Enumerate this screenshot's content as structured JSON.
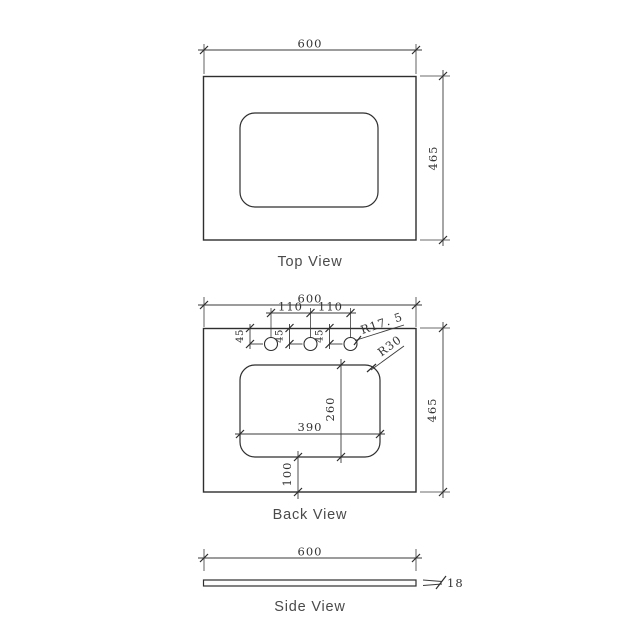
{
  "top_view": {
    "label": "Top View",
    "width": "600",
    "height": "465"
  },
  "back_view": {
    "label": "Back View",
    "width": "600",
    "height": "465",
    "hole_spacings": [
      "110",
      "110"
    ],
    "hole_offsets": [
      "45",
      "45",
      "45"
    ],
    "hole_radius_label": "R17. 5",
    "basin_corner_radius_label": "R30",
    "basin_width": "390",
    "basin_depth": "260",
    "basin_bottom_offset": "100"
  },
  "side_view": {
    "label": "Side View",
    "width": "600",
    "thickness": "18"
  },
  "colors": {
    "line": "#2e2e2e",
    "dim_text": "#333333",
    "label_text": "#4a4a4a",
    "background": "#ffffff"
  }
}
